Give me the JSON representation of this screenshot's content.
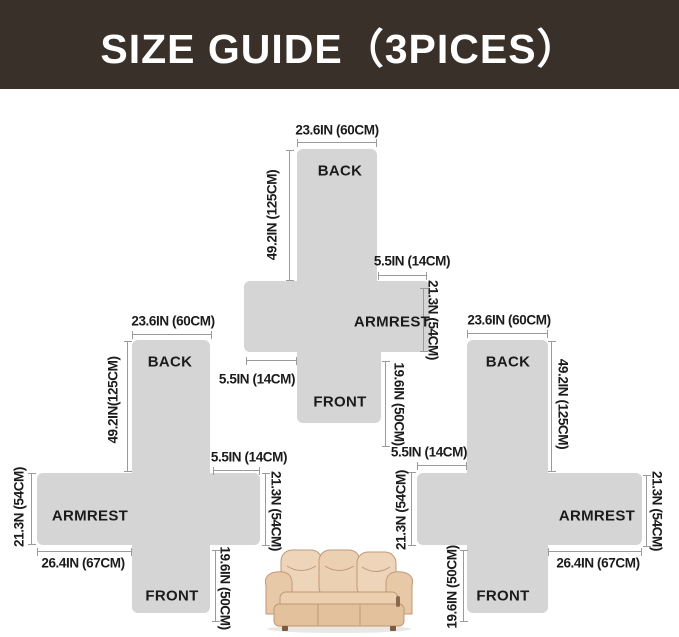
{
  "header": {
    "title": "SIZE GUIDE（3PICES）"
  },
  "colors": {
    "header_bg": "#39302a",
    "header_text": "#ffffff",
    "piece_fill": "#d5d5d5",
    "dim_line": "#9b9b9b",
    "label_text": "#1b1b1b",
    "sofa_body": "#eed5ba"
  },
  "pieces": {
    "center": {
      "width_top": "23.6IN (60CM)",
      "back": "BACK",
      "height": "49.2IN (125CM)",
      "arm_top": "5.5IN (14CM)",
      "arm_height": "21.3N (54CM)",
      "armrest": "ARMREST",
      "arm_bottom_left": "5.5IN (14CM)",
      "front": "FRONT",
      "front_depth": "19.6IN (50CM)"
    },
    "left": {
      "width_top": "23.6IN (60CM)",
      "back": "BACK",
      "height": "49.2IN(125CM)",
      "outer_arm_height": "21.3N (54CM)",
      "armrest": "ARMREST",
      "arm_length": "26.4IN (67CM)",
      "stub_top": "5.5IN (14CM)",
      "inner_arm_height": "21.3N (54CM)",
      "front": "FRONT",
      "front_depth": "19.6IN (50CM)"
    },
    "right": {
      "width_top": "23.6IN (60CM)",
      "back": "BACK",
      "height": "49.2IN (125CM)",
      "stub_top": "5.5IN (14CM)",
      "inner_arm_height": "21.3N (54CM)",
      "armrest": "ARMREST",
      "outer_arm_height": "21.3N (54CM)",
      "arm_length": "26.4IN (67CM)",
      "front": "FRONT",
      "front_depth": "19.6IN (50CM)"
    }
  },
  "illustration": {
    "sofa_icon": "three-seat-recliner-sofa"
  }
}
